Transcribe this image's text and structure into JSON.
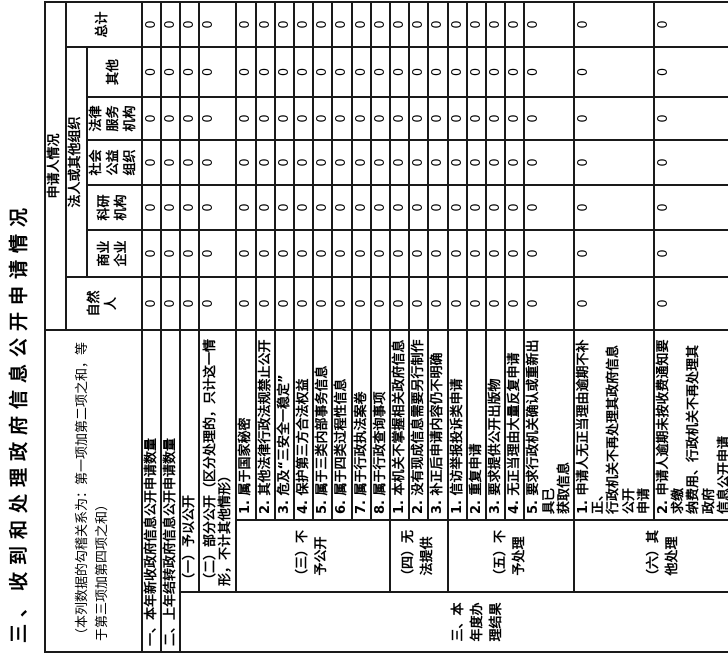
{
  "colors": {
    "background": "#ffffff",
    "border": "#1a1a1a",
    "text": "#000000"
  },
  "title": "三、收到和处理政府信息公开申请情况",
  "note": "（本列数据的勾稽关系为：第一项加第二项之和，等\n于第三项加第四项之和）",
  "header": {
    "applicant": "申请人情况",
    "natural_person": "自然\n人",
    "legal_person": "法人或其他组织",
    "total": "总计",
    "sub": [
      "商业\n企业",
      "科研\n机构",
      "社会\n公益\n组织",
      "法律\n服务\n机构",
      "其他"
    ]
  },
  "rows": [
    {
      "label": "一、本年新收政府信息公开申请数量",
      "values": [
        "0",
        "0",
        "0",
        "0",
        "0",
        "0",
        "0"
      ]
    },
    {
      "label": "二、上年结转政府信息公开申请数量",
      "values": [
        "0",
        "0",
        "0",
        "0",
        "0",
        "0",
        "0"
      ]
    },
    {
      "group": "三、本\n年度办\n理结果",
      "label": "（一）予以公开",
      "values": [
        "0",
        "0",
        "0",
        "0",
        "0",
        "0",
        "0"
      ]
    },
    {
      "label": "（二）部分公开（区分处理的，只计这一情\n形，不计其他情形）",
      "values": [
        "0",
        "0",
        "0",
        "0",
        "0",
        "0",
        "0"
      ]
    },
    {
      "subgroup": "（三）不\n予公开",
      "label": "1. 属于国家秘密",
      "values": [
        "0",
        "0",
        "0",
        "0",
        "0",
        "0",
        "0"
      ]
    },
    {
      "label": "2. 其他法律行政法规禁止公开",
      "values": [
        "0",
        "0",
        "0",
        "0",
        "0",
        "0",
        "0"
      ]
    },
    {
      "label": "3. 危及“三安全一稳定”",
      "values": [
        "0",
        "0",
        "0",
        "0",
        "0",
        "0",
        "0"
      ]
    },
    {
      "label": "4. 保护第三方合法权益",
      "values": [
        "0",
        "0",
        "0",
        "0",
        "0",
        "0",
        "0"
      ]
    },
    {
      "label": "5. 属于三类内部事务信息",
      "values": [
        "0",
        "0",
        "0",
        "0",
        "0",
        "0",
        "0"
      ]
    },
    {
      "label": "6. 属于四类过程性信息",
      "values": [
        "0",
        "0",
        "0",
        "0",
        "0",
        "0",
        "0"
      ]
    },
    {
      "label": "7. 属于行政执法案卷",
      "values": [
        "0",
        "0",
        "0",
        "0",
        "0",
        "0",
        "0"
      ]
    },
    {
      "label": "8. 属于行政查询事项",
      "values": [
        "0",
        "0",
        "0",
        "0",
        "0",
        "0",
        "0"
      ]
    },
    {
      "subgroup": "（四）无\n法提供",
      "label": "1. 本机关不掌握相关政府信息",
      "values": [
        "0",
        "0",
        "0",
        "0",
        "0",
        "0",
        "0"
      ]
    },
    {
      "label": "2. 没有现成信息需要另行制作",
      "values": [
        "0",
        "0",
        "0",
        "0",
        "0",
        "0",
        "0"
      ]
    },
    {
      "label": "3. 补正后申请内容仍不明确",
      "values": [
        "0",
        "0",
        "0",
        "0",
        "0",
        "0",
        "0"
      ]
    },
    {
      "subgroup": "（五）不\n予处理",
      "label": "1. 信访举报投诉类申请",
      "values": [
        "0",
        "0",
        "0",
        "0",
        "0",
        "0",
        "0"
      ]
    },
    {
      "label": "2. 重复申请",
      "values": [
        "0",
        "0",
        "0",
        "0",
        "0",
        "0",
        "0"
      ]
    },
    {
      "label": "3. 要求提供公开出版物",
      "values": [
        "0",
        "0",
        "0",
        "0",
        "0",
        "0",
        "0"
      ]
    },
    {
      "label": "4. 无正当理由大量反复申请",
      "values": [
        "0",
        "0",
        "0",
        "0",
        "0",
        "0",
        "0"
      ]
    },
    {
      "label": "5. 要求行政机关确认或重新出具已\n获取信息",
      "values": [
        "0",
        "0",
        "0",
        "0",
        "0",
        "0",
        "0"
      ]
    },
    {
      "subgroup": "（六）其\n他处理",
      "label": "1. 申请人无正当理由逾期不补正、\n行政机关不再处理其政府信息公开\n申请",
      "values": [
        "0",
        "0",
        "0",
        "0",
        "0",
        "0",
        "0"
      ]
    },
    {
      "label": "2. 申请人逾期未按收费通知要求缴\n纳费用、行政机关不再处理其政府\n信息公开申请",
      "values": [
        "0",
        "0",
        "0",
        "0",
        "0",
        "0",
        "0"
      ]
    },
    {
      "label": "3. 其他",
      "values": [
        "0",
        "0",
        "0",
        "0",
        "0",
        "0",
        "0"
      ]
    },
    {
      "label": "（七）总计",
      "values": [
        "0",
        "0",
        "0",
        "0",
        "0",
        "0",
        "0"
      ]
    },
    {
      "label": "四、结转下年度继续办理",
      "values": [
        "0",
        "0",
        "0",
        "0",
        "0",
        "0",
        "0"
      ]
    }
  ]
}
